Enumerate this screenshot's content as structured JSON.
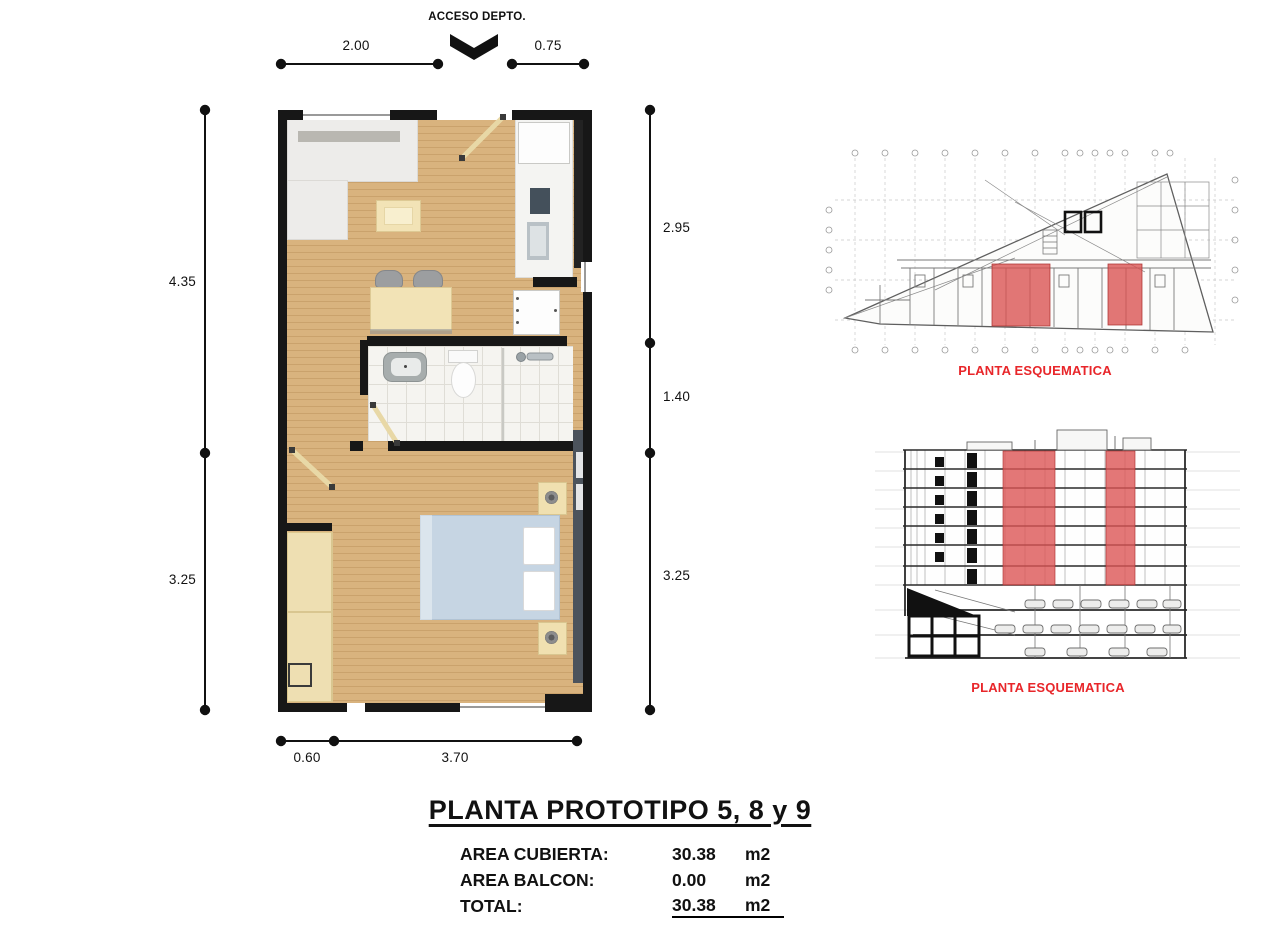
{
  "floor_plan": {
    "access_label": "ACCESO DEPTO.",
    "dimensions": {
      "top": [
        {
          "label": "2.00"
        },
        {
          "label": "0.75"
        }
      ],
      "left": [
        {
          "label": "4.35"
        },
        {
          "label": "3.25"
        }
      ],
      "right": [
        {
          "label": "2.95"
        },
        {
          "label": "1.40"
        },
        {
          "label": "3.25"
        }
      ],
      "bottom": [
        {
          "label": "0.60"
        },
        {
          "label": "3.70"
        }
      ]
    }
  },
  "schematics": [
    {
      "caption": "PLANTA ESQUEMATICA"
    },
    {
      "caption": "PLANTA ESQUEMATICA"
    }
  ],
  "summary": {
    "title": "PLANTA PROTOTIPO 5, 8 y 9",
    "rows": [
      {
        "label": "AREA CUBIERTA:",
        "value": "30.38",
        "unit": "m2"
      },
      {
        "label": "AREA BALCON:",
        "value": "0.00",
        "unit": "m2"
      },
      {
        "label": "TOTAL:",
        "value": "30.38",
        "unit": "m2"
      }
    ]
  },
  "colors": {
    "accent_red_text": "#e8262a",
    "highlight_red": "#d95f5f",
    "wall_black": "#171717",
    "wood_floor": "#d9b37e",
    "bed_blue": "#c6d5e3",
    "furniture_cream": "#f2e3b6"
  }
}
